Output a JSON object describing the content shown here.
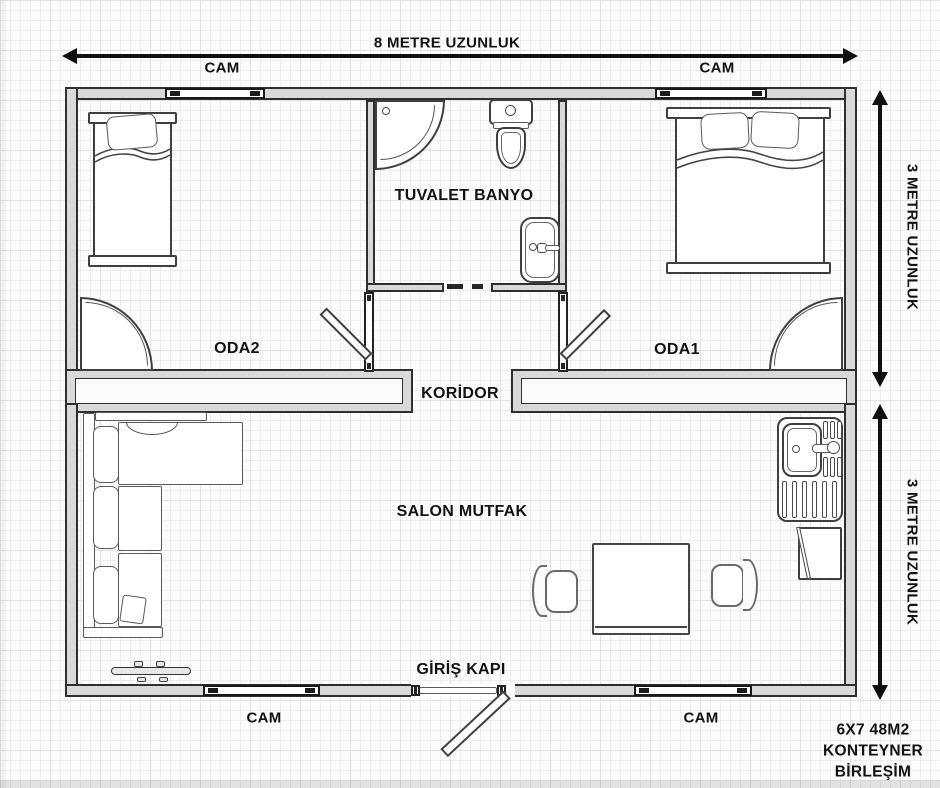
{
  "dims": {
    "top": "8 METRE UZUNLUK",
    "right_upper": "3 METRE UZUNLUK",
    "right_lower": "3 METRE UZUNLUK"
  },
  "windows": {
    "top_left": "CAM",
    "top_right": "CAM",
    "bottom_left": "CAM",
    "bottom_right": "CAM"
  },
  "rooms": {
    "oda2": "ODA2",
    "oda1": "ODA1",
    "bathroom": "TUVALET BANYO",
    "corridor": "KORİDOR",
    "living": "SALON MUTFAK"
  },
  "entrance": {
    "label": "GİRİŞ KAPI"
  },
  "note": {
    "line1": "6X7 48M2",
    "line2": "KONTEYNER",
    "line3": "BİRLEŞİM"
  },
  "colors": {
    "wall_fill": "#d9d9d9",
    "outline": "#2f2f2f",
    "text": "#121212",
    "arrow": "#101010",
    "paper": "#fcfcfc"
  }
}
